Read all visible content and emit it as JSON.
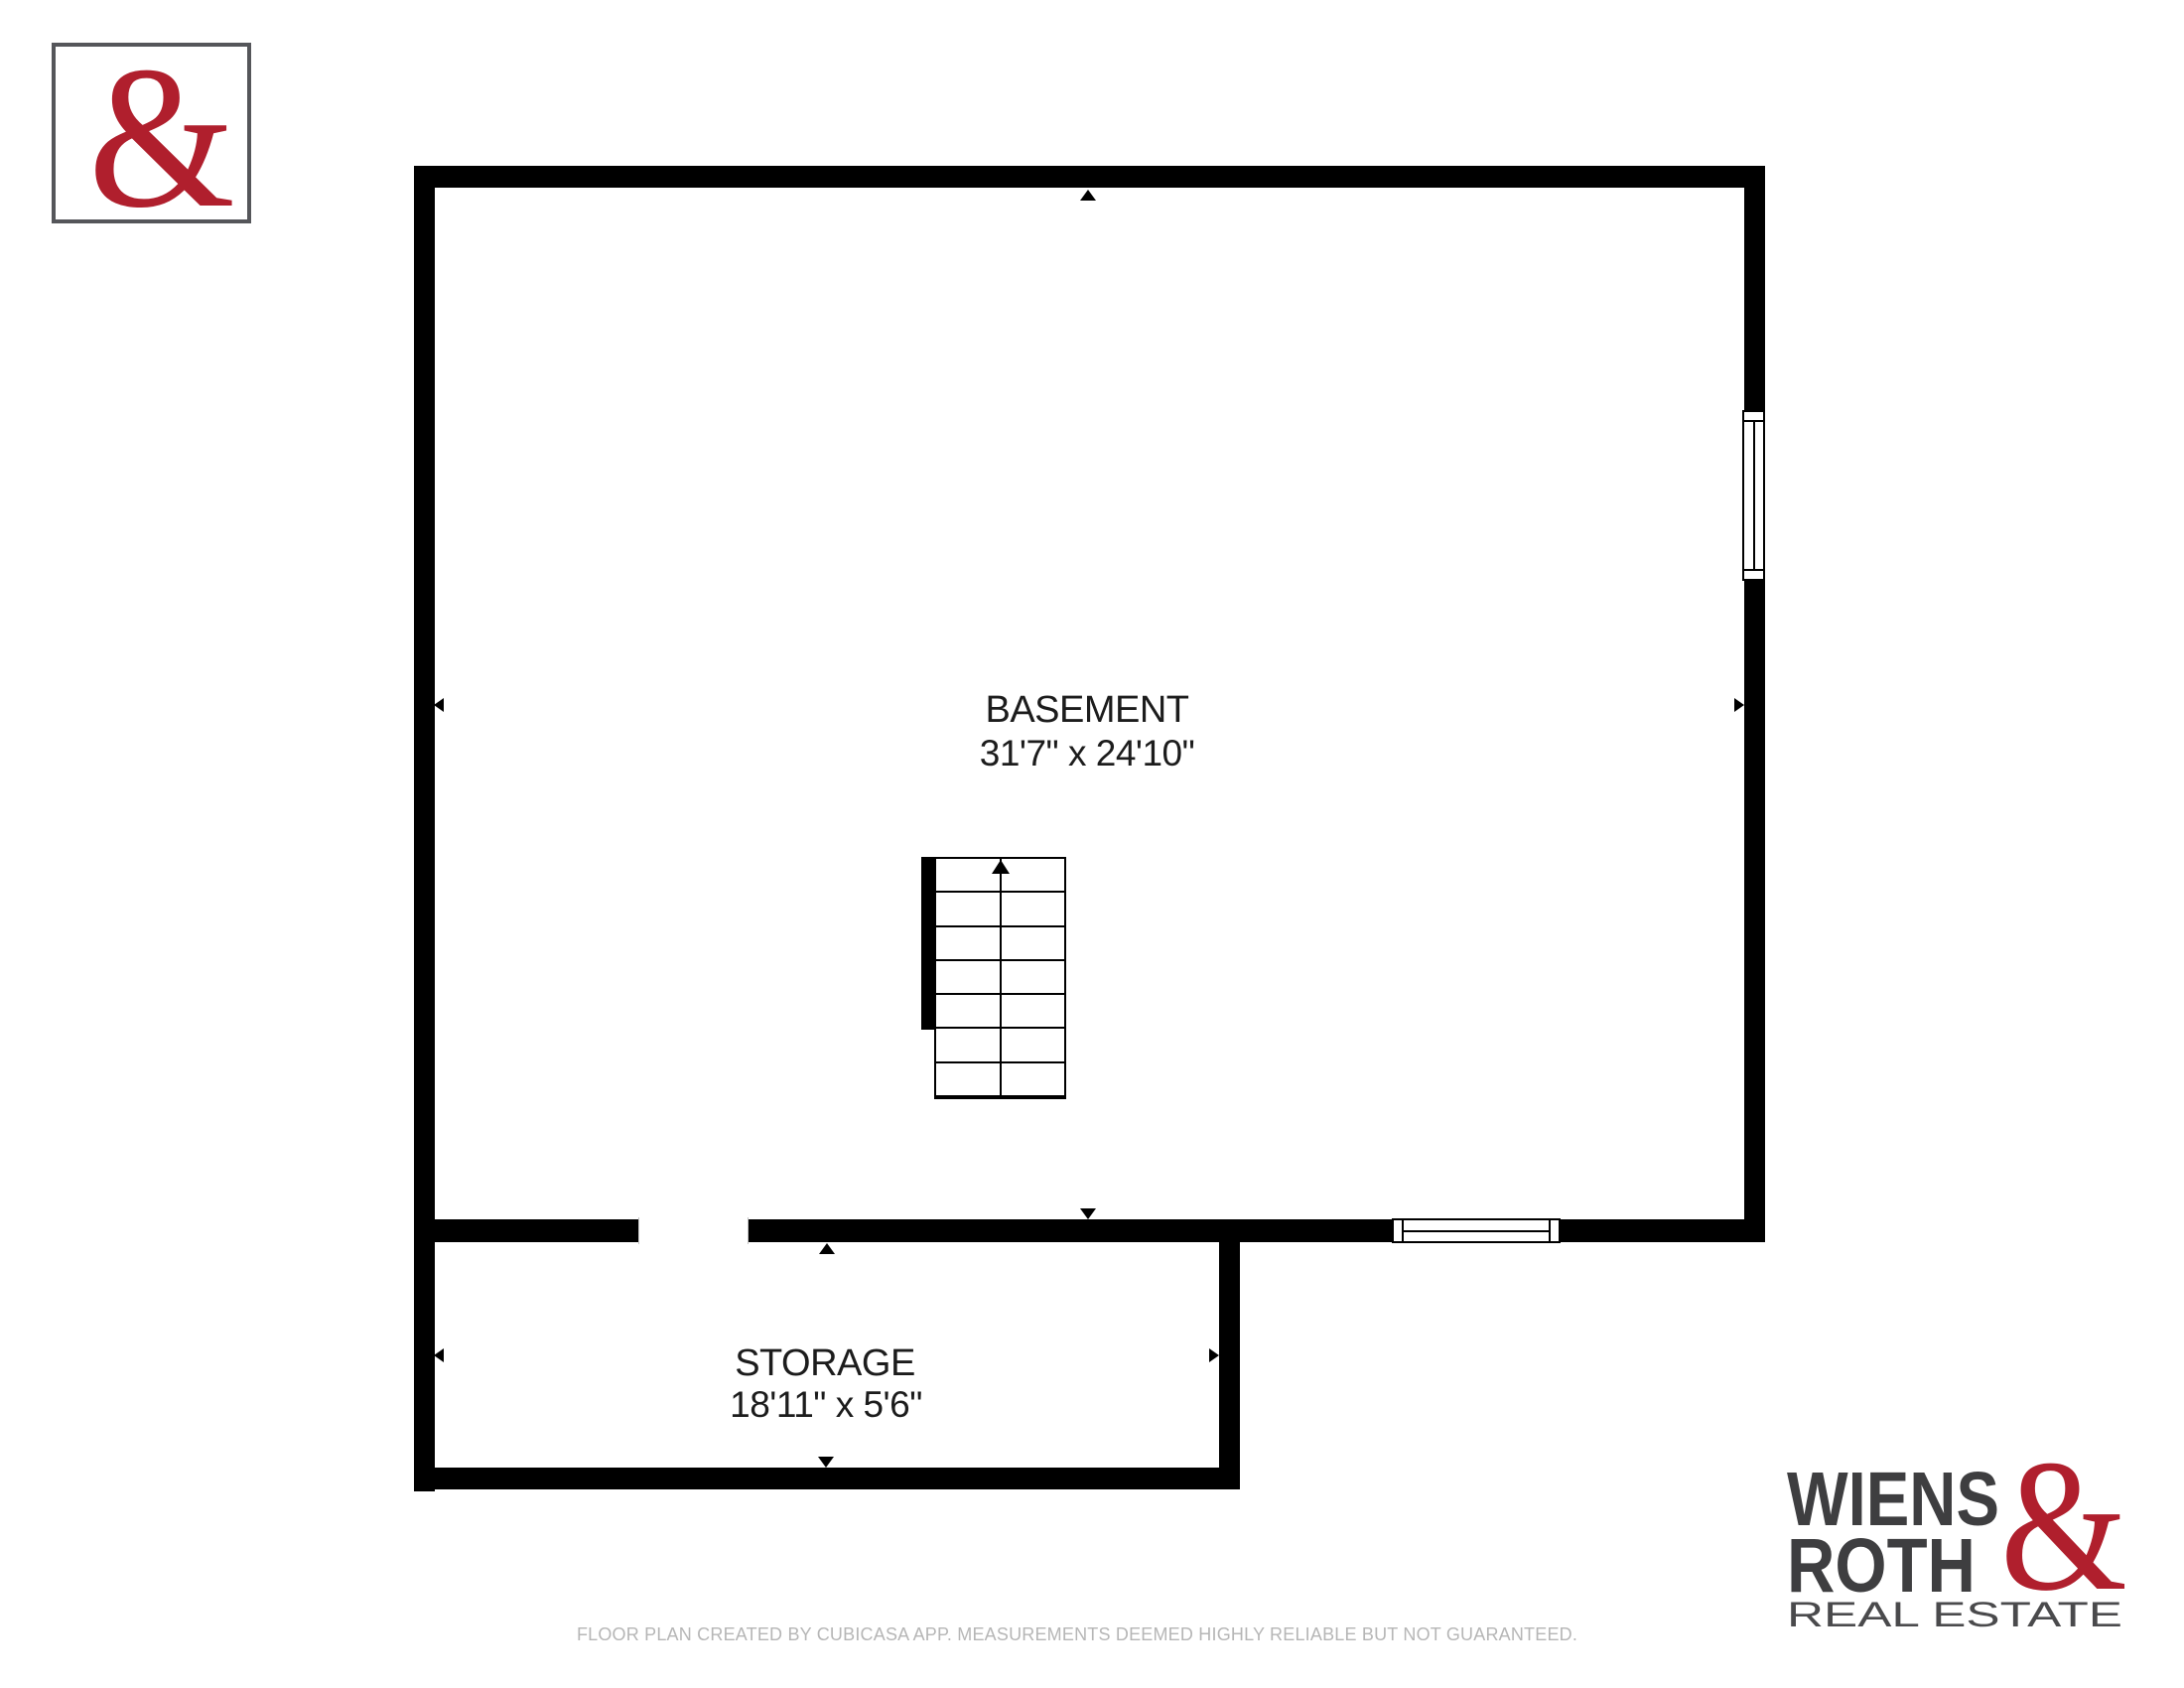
{
  "brand": {
    "ampersand": "&",
    "wiens": "WIENS",
    "roth": "ROTH",
    "real_estate": "REAL ESTATE",
    "accent_red": "#b01f2d",
    "dark_gray": "#3e3e40",
    "logo_border_color": "#55565a"
  },
  "floorplan": {
    "wall_color": "#000000",
    "rooms": [
      {
        "name": "BASEMENT",
        "dimensions": "31'7\" x 24'10\""
      },
      {
        "name": "STORAGE",
        "dimensions": "18'11\" x 5'6\""
      }
    ]
  },
  "footer": {
    "disclaimer": "FLOOR PLAN CREATED BY CUBICASA APP. MEASUREMENTS DEEMED HIGHLY RELIABLE BUT NOT GUARANTEED."
  }
}
